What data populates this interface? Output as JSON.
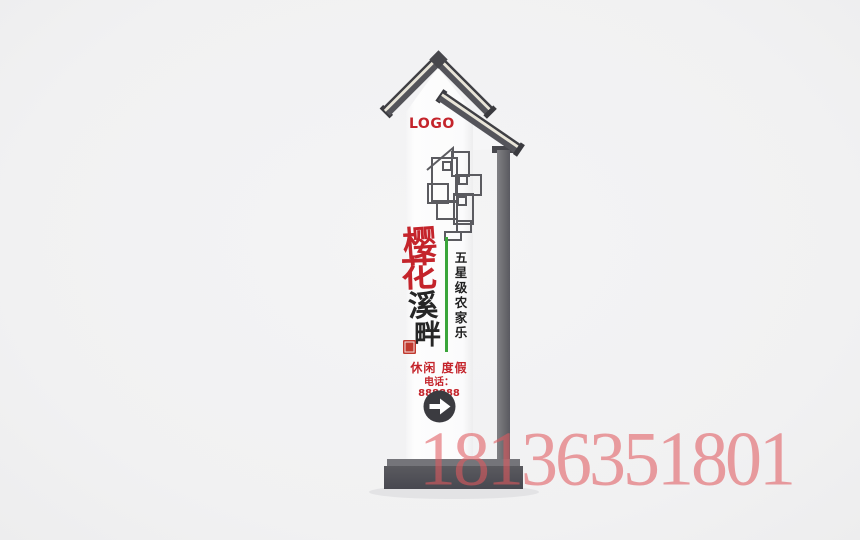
{
  "page": {
    "background_color": "#f1f1f2",
    "description": "render of a vertical chinese-style farmhouse wayfinding sign pylon"
  },
  "sign": {
    "logo": "LOGO",
    "brand": {
      "chars": [
        "樱",
        "花",
        "溪",
        "畔"
      ]
    },
    "tagline": {
      "chars": [
        "五",
        "星",
        "级",
        "农",
        "家",
        "乐"
      ]
    },
    "services": "休闲 度假",
    "phone": "电话：888888",
    "arrow_icon": "arrow-right",
    "colors": {
      "accent_red": "#c4242b",
      "divider_green": "#3aa53a",
      "structure_dark": "#54545a",
      "roof_stripe_cream": "#e9e5d8",
      "board_white": "#fbfbfc",
      "arrow_circle": "#3b3b40"
    }
  },
  "watermark": {
    "text": "18136351801",
    "color": "#e05a5e"
  }
}
